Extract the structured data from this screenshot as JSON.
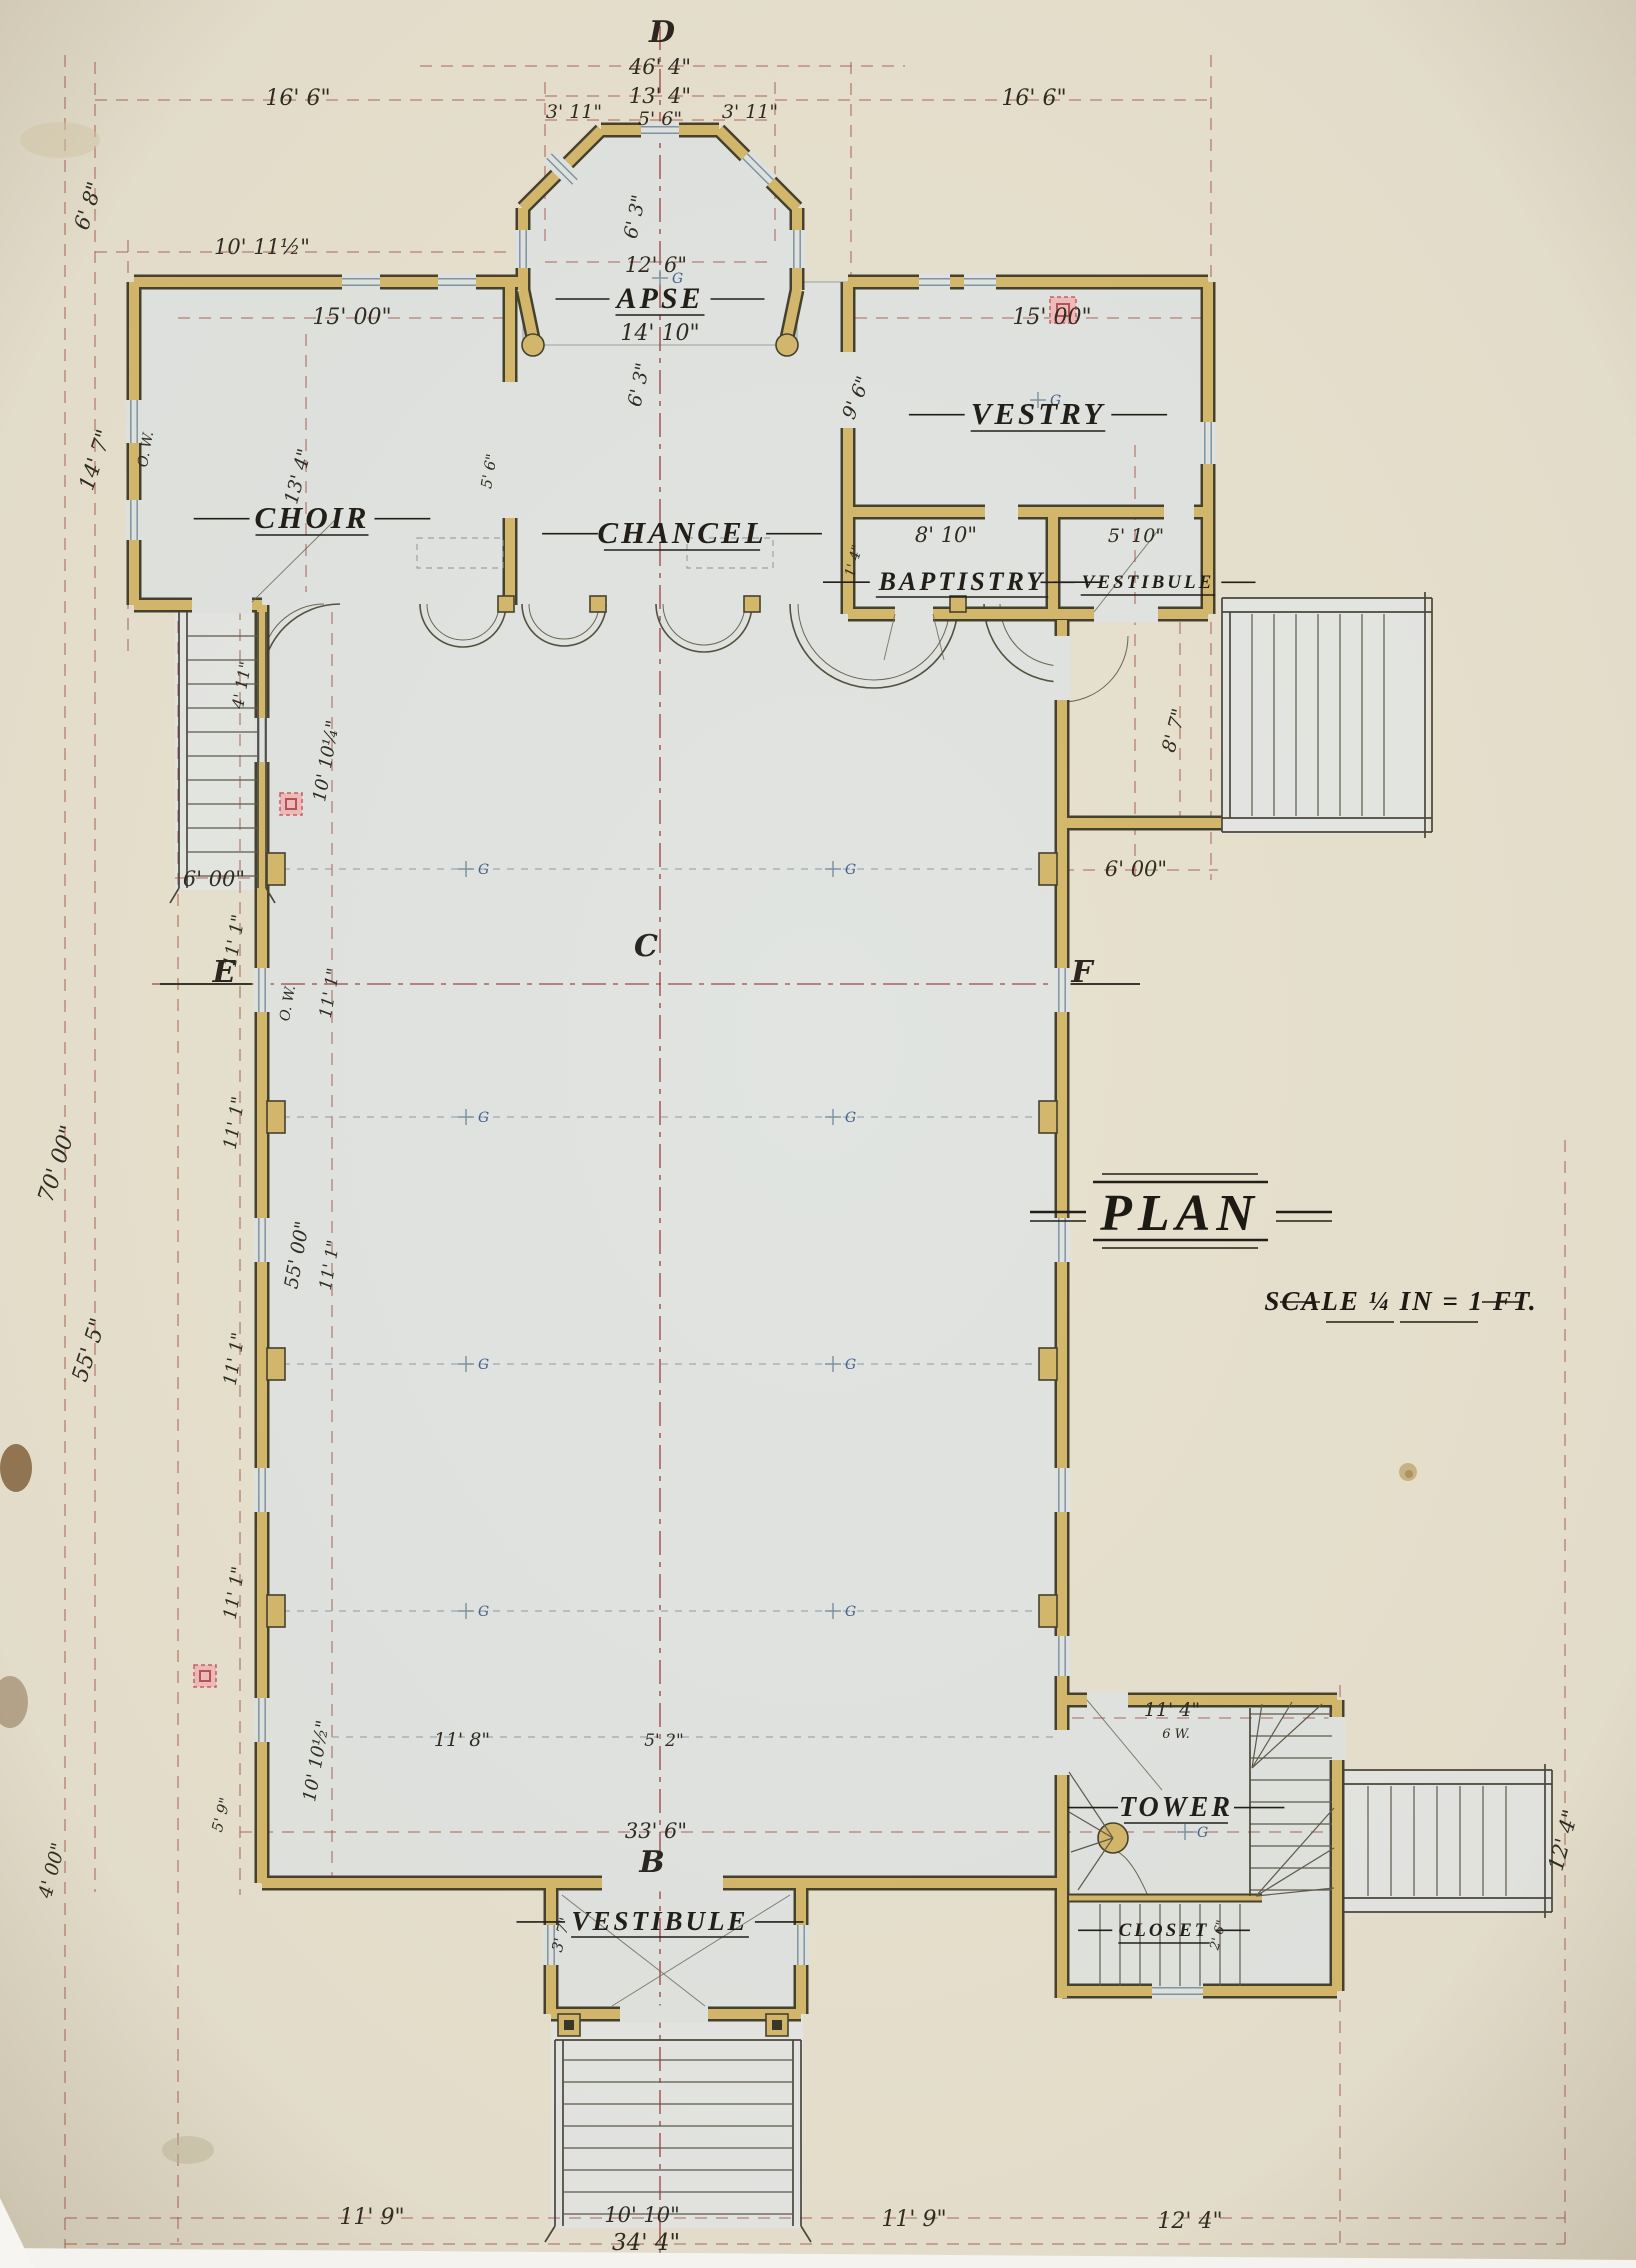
{
  "title": {
    "text": "PLAN"
  },
  "scale_note": {
    "text": "SCALE ¼ IN = 1 FT."
  },
  "rooms": [
    {
      "id": "apse",
      "label": "APSE",
      "x": 660,
      "y": 308,
      "size": 30
    },
    {
      "id": "choir",
      "label": "CHOIR",
      "x": 312,
      "y": 528,
      "size": 31
    },
    {
      "id": "chancel",
      "label": "CHANCEL",
      "x": 682,
      "y": 543,
      "size": 31
    },
    {
      "id": "vestry",
      "label": "VESTRY",
      "x": 1038,
      "y": 424,
      "size": 31
    },
    {
      "id": "baptistry",
      "label": "BAPTISTRY",
      "x": 962,
      "y": 590,
      "size": 26
    },
    {
      "id": "vestibule-east",
      "label": "VESTIBULE",
      "x": 1148,
      "y": 588,
      "size": 19
    },
    {
      "id": "tower",
      "label": "TOWER",
      "x": 1176,
      "y": 1816,
      "size": 28
    },
    {
      "id": "closet",
      "label": "CLOSET",
      "x": 1164,
      "y": 1936,
      "size": 19
    },
    {
      "id": "vestibule-south",
      "label": "VESTIBULE",
      "x": 660,
      "y": 1930,
      "size": 27
    }
  ],
  "section_markers": [
    {
      "text": "D",
      "x": 662,
      "y": 42
    },
    {
      "text": "B",
      "x": 652,
      "y": 1872
    },
    {
      "text": "C",
      "x": 646,
      "y": 956
    },
    {
      "text": "E",
      "x": 224,
      "y": 982
    },
    {
      "text": "F",
      "x": 1082,
      "y": 982
    }
  ],
  "light_fixtures": {
    "symbol_label": "G",
    "points": [
      {
        "x": 466,
        "y": 869
      },
      {
        "x": 833,
        "y": 869
      },
      {
        "x": 466,
        "y": 1117
      },
      {
        "x": 833,
        "y": 1117
      },
      {
        "x": 466,
        "y": 1364
      },
      {
        "x": 833,
        "y": 1364
      },
      {
        "x": 466,
        "y": 1611
      },
      {
        "x": 833,
        "y": 1611
      },
      {
        "x": 1185,
        "y": 1832
      },
      {
        "x": 660,
        "y": 278
      },
      {
        "x": 1038,
        "y": 400
      }
    ]
  },
  "dimensions": [
    {
      "text": "46' 4\"",
      "x": 660,
      "y": 74
    },
    {
      "text": "13' 4\"",
      "x": 660,
      "y": 103
    },
    {
      "text": "5' 6\"",
      "x": 660,
      "y": 125,
      "size": 19
    },
    {
      "text": "3' 11\"",
      "x": 574,
      "y": 118,
      "size": 19
    },
    {
      "text": "3' 11\"",
      "x": 750,
      "y": 118,
      "size": 19
    },
    {
      "text": "16' 6\"",
      "x": 298,
      "y": 105,
      "size": 22
    },
    {
      "text": "16' 6\"",
      "x": 1034,
      "y": 105,
      "size": 22
    },
    {
      "text": "6' 8\"",
      "x": 95,
      "y": 208,
      "rot": -72
    },
    {
      "text": "10' 11½\"",
      "x": 262,
      "y": 254
    },
    {
      "text": "15' 00\"",
      "x": 352,
      "y": 324,
      "size": 22
    },
    {
      "text": "15' 00\"",
      "x": 1052,
      "y": 324,
      "size": 22
    },
    {
      "text": "12' 6\"",
      "x": 656,
      "y": 272
    },
    {
      "text": "14' 10\"",
      "x": 660,
      "y": 340,
      "size": 22
    },
    {
      "text": "6' 3\"",
      "x": 641,
      "y": 218,
      "rot": -78,
      "size": 19
    },
    {
      "text": "6' 3\"",
      "x": 645,
      "y": 386,
      "rot": -78,
      "size": 19
    },
    {
      "text": "14' 7\"",
      "x": 102,
      "y": 462,
      "rot": -72
    },
    {
      "text": "13' 4\"",
      "x": 304,
      "y": 478,
      "rot": -75,
      "size": 19
    },
    {
      "text": "5' 6\"",
      "x": 494,
      "y": 472,
      "rot": -80,
      "size": 15
    },
    {
      "text": "9' 6\"",
      "x": 862,
      "y": 400,
      "rot": -68,
      "size": 19
    },
    {
      "text": "1' 4\"",
      "x": 858,
      "y": 562,
      "rot": -75,
      "size": 14
    },
    {
      "text": "8' 10\"",
      "x": 946,
      "y": 542
    },
    {
      "text": "5' 10\"",
      "x": 1136,
      "y": 542,
      "size": 19
    },
    {
      "text": "O. W.",
      "x": 150,
      "y": 450,
      "rot": -80,
      "size": 14
    },
    {
      "text": "O. W.",
      "x": 292,
      "y": 1004,
      "rot": -80,
      "size": 14
    },
    {
      "text": "8' 7\"",
      "x": 1180,
      "y": 732,
      "rot": -75,
      "size": 19
    },
    {
      "text": "6' 00\"",
      "x": 1136,
      "y": 876
    },
    {
      "text": "6' 00\"",
      "x": 214,
      "y": 886
    },
    {
      "text": "4' 11\"",
      "x": 247,
      "y": 686,
      "rot": -80,
      "size": 16
    },
    {
      "text": "11' 1\"",
      "x": 240,
      "y": 942,
      "rot": -80,
      "size": 18
    },
    {
      "text": "11' 1\"",
      "x": 335,
      "y": 994,
      "rot": -80,
      "size": 17
    },
    {
      "text": "11' 1\"",
      "x": 240,
      "y": 1124,
      "rot": -80,
      "size": 18
    },
    {
      "text": "11' 1\"",
      "x": 240,
      "y": 1360,
      "rot": -80,
      "size": 18
    },
    {
      "text": "55' 00\"",
      "x": 303,
      "y": 1256,
      "rot": -80,
      "size": 19
    },
    {
      "text": "11' 1\"",
      "x": 335,
      "y": 1266,
      "rot": -80,
      "size": 17
    },
    {
      "text": "11' 1\"",
      "x": 240,
      "y": 1594,
      "rot": -80,
      "size": 18
    },
    {
      "text": "10' 10¼\"",
      "x": 332,
      "y": 762,
      "rot": -80,
      "size": 18
    },
    {
      "text": "10' 10½\"",
      "x": 322,
      "y": 1762,
      "rot": -80,
      "size": 18
    },
    {
      "text": "70' 00\"",
      "x": 64,
      "y": 1166,
      "rot": -72,
      "size": 22
    },
    {
      "text": "55' 5\"",
      "x": 96,
      "y": 1352,
      "rot": -72,
      "size": 22
    },
    {
      "text": "4' 00\"",
      "x": 58,
      "y": 1872,
      "rot": -75,
      "size": 19
    },
    {
      "text": "5' 9\"",
      "x": 226,
      "y": 1816,
      "rot": -75,
      "size": 15
    },
    {
      "text": "11' 8\"",
      "x": 462,
      "y": 1746,
      "size": 19
    },
    {
      "text": "5' 2\"",
      "x": 664,
      "y": 1746,
      "size": 17
    },
    {
      "text": "33' 6\"",
      "x": 656,
      "y": 1838
    },
    {
      "text": "3' 7\"",
      "x": 566,
      "y": 1936,
      "rot": -75,
      "size": 15
    },
    {
      "text": "11' 4\"",
      "x": 1172,
      "y": 1716,
      "size": 19
    },
    {
      "text": "6 W.",
      "x": 1176,
      "y": 1738,
      "size": 13
    },
    {
      "text": "2' 6\"",
      "x": 1222,
      "y": 1936,
      "rot": -75,
      "size": 13
    },
    {
      "text": "11' 9\"",
      "x": 372,
      "y": 2224,
      "size": 22
    },
    {
      "text": "10' 10\"",
      "x": 642,
      "y": 2222
    },
    {
      "text": "34' 4\"",
      "x": 646,
      "y": 2250,
      "size": 23
    },
    {
      "text": "11' 9\"",
      "x": 914,
      "y": 2226,
      "size": 22
    },
    {
      "text": "12' 4\"",
      "x": 1190,
      "y": 2228,
      "size": 22
    },
    {
      "text": "12' 4\"",
      "x": 1570,
      "y": 1842,
      "rot": -75,
      "size": 21
    }
  ],
  "colors": {
    "paper": "#e7e1cf",
    "floor": "#e1e4e1",
    "wall": "#d4b86c",
    "wall_edge": "#45412f",
    "dimension_line": "#a85a50",
    "center_line": "#9e3f3f",
    "ink": "#2f2b22",
    "fixture_blue": "#44618f",
    "chimney_pink": "#f0bcbc"
  }
}
